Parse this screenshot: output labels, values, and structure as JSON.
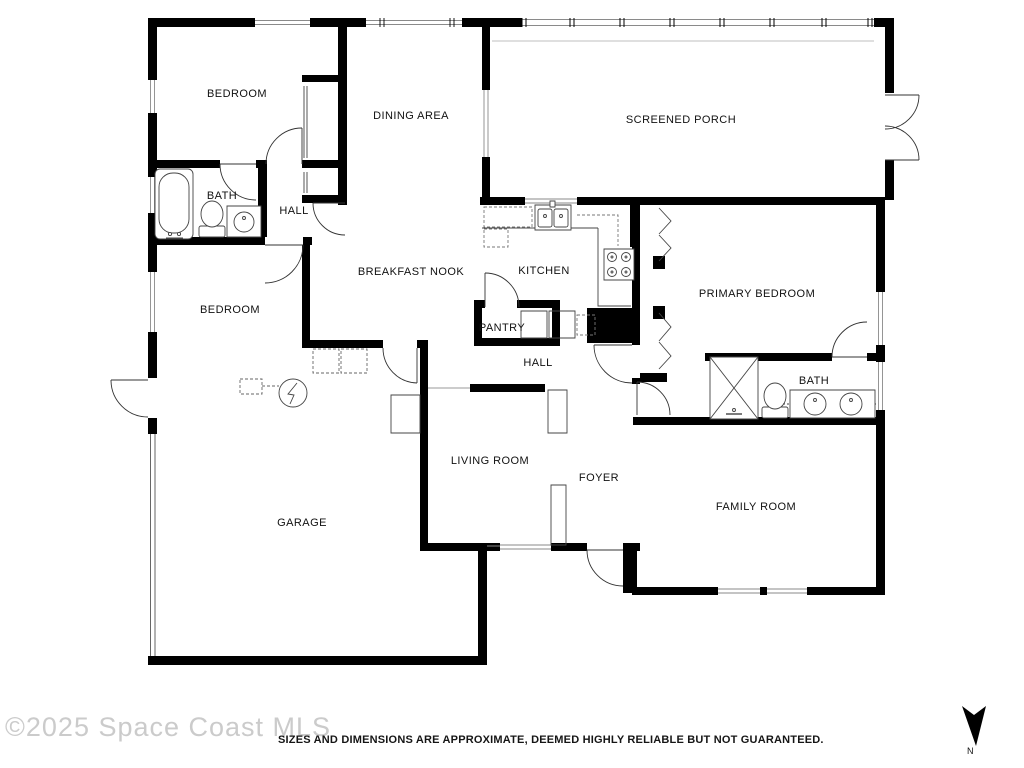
{
  "floor_plan": {
    "title": "Single-story residential floor plan",
    "rooms": [
      {
        "name": "bedroom-1",
        "label": "BEDROOM",
        "x": 237,
        "y": 94
      },
      {
        "name": "dining-area",
        "label": "DINING AREA",
        "x": 411,
        "y": 116
      },
      {
        "name": "screened-porch",
        "label": "SCREENED PORCH",
        "x": 681,
        "y": 120
      },
      {
        "name": "bath-1",
        "label": "BATH",
        "x": 222,
        "y": 196
      },
      {
        "name": "hall-upper",
        "label": "HALL",
        "x": 294,
        "y": 211
      },
      {
        "name": "breakfast-nook",
        "label": "BREAKFAST NOOK",
        "x": 411,
        "y": 272
      },
      {
        "name": "kitchen",
        "label": "KITCHEN",
        "x": 544,
        "y": 271
      },
      {
        "name": "primary-bedroom",
        "label": "PRIMARY BEDROOM",
        "x": 757,
        "y": 294
      },
      {
        "name": "bedroom-2",
        "label": "BEDROOM",
        "x": 230,
        "y": 310
      },
      {
        "name": "pantry",
        "label": "PANTRY",
        "x": 502,
        "y": 328
      },
      {
        "name": "hall-lower",
        "label": "HALL",
        "x": 538,
        "y": 363
      },
      {
        "name": "bath-primary",
        "label": "BATH",
        "x": 814,
        "y": 381
      },
      {
        "name": "living-room",
        "label": "LIVING ROOM",
        "x": 490,
        "y": 461
      },
      {
        "name": "foyer",
        "label": "FOYER",
        "x": 599,
        "y": 478
      },
      {
        "name": "garage",
        "label": "GARAGE",
        "x": 302,
        "y": 523
      },
      {
        "name": "family-room",
        "label": "FAMILY ROOM",
        "x": 756,
        "y": 507
      }
    ],
    "fixtures": [
      "bathtub",
      "toilet",
      "vanity-sink",
      "kitchen-sink",
      "stove",
      "shower",
      "washer",
      "dryer",
      "water-heater",
      "bifold-closet-doors",
      "garage-door"
    ],
    "footer": {
      "watermark": "©2025 Space Coast MLS",
      "disclaimer": "SIZES AND DIMENSIONS ARE APPROXIMATE, DEEMED HIGHLY RELIABLE BUT NOT GUARANTEED.",
      "compass_label": "N"
    },
    "colors": {
      "wall": "#000000",
      "background": "#ffffff",
      "watermark": "#cbcbcb",
      "text": "#111111"
    }
  }
}
